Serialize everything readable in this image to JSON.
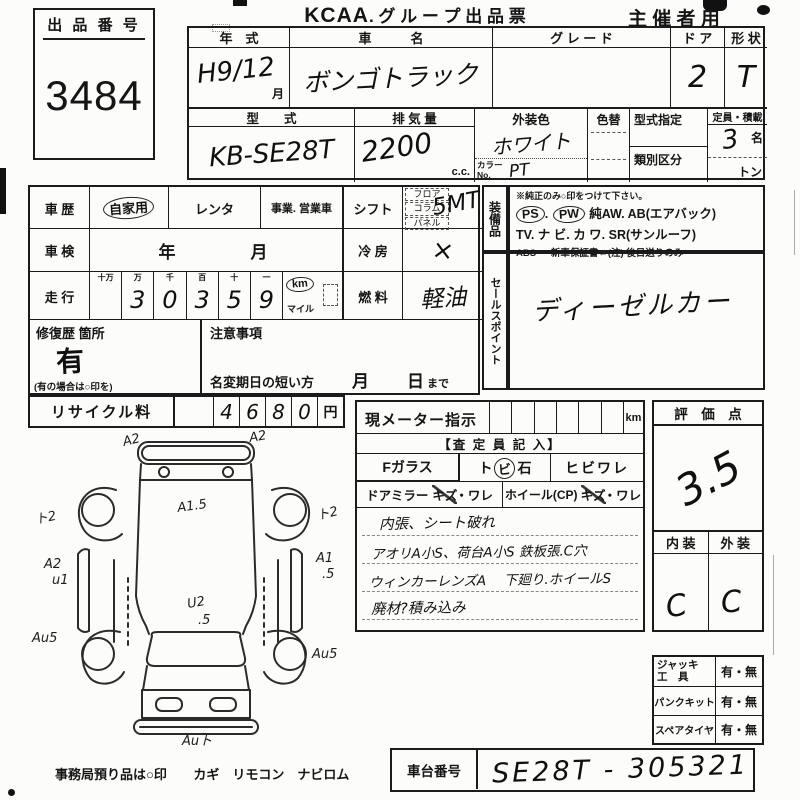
{
  "page": {
    "title_logo": "KCAA",
    "title_text": ". グ ル ー プ  出 品 票",
    "organizer": "主 催 者 用"
  },
  "lot": {
    "label": "出 品 番 号",
    "number": "3484"
  },
  "vehicle": {
    "year_label": "年　式",
    "year_value": "H9/12",
    "year_unit": "月",
    "name_label": "車　　　名",
    "name_value": "ボンゴトラック",
    "grade_label": "グ レ ー ド",
    "grade_value": "",
    "door_label": "ド ア",
    "door_value": "2",
    "shape_label": "形 状",
    "shape_value": "T",
    "model_label": "型　　式",
    "model_value": "KB-SE28T",
    "disp_label": "排 気 量",
    "disp_value": "2200",
    "disp_unit": "c.c.",
    "color_label": "外装色",
    "color_value": "ホワイト",
    "colorchg_label": "色替",
    "colorno_label": "カラーNo.",
    "colorno_value": "PT",
    "modeldesig_label": "型式指定",
    "class_label": "類別区分",
    "capacity_label": "定員・積載",
    "capacity_value": "3",
    "capacity_unit": "名",
    "load_unit": "トン"
  },
  "history": {
    "label": "車 歴",
    "opt1": "自家用",
    "opt2": "レンタ",
    "opt3": "事業. 営業車"
  },
  "shaken": {
    "label": "車 検",
    "value": "年　　　月"
  },
  "mileage": {
    "label": "走 行",
    "h0": "十万",
    "h1": "万",
    "h2": "千",
    "h3": "百",
    "h4": "十",
    "h5": "一",
    "d0": "",
    "d1": "3",
    "d2": "0",
    "d3": "3",
    "d4": "5",
    "d5": "9",
    "unit": "km",
    "unit2": "マイル"
  },
  "shift": {
    "label": "シフト",
    "opt1": "フロア",
    "opt2": "コラム",
    "opt3": "パネル",
    "value": "5MT"
  },
  "aircon": {
    "label": "冷 房",
    "value": "×"
  },
  "fuel": {
    "label": "燃 料",
    "value": "軽油"
  },
  "repair": {
    "label": "修復歴 箇所",
    "value": "有",
    "note": "(有の場合は○印を)"
  },
  "caution": {
    "label": "注意事項",
    "text": "名変期日の短い方",
    "month": "月",
    "day": "日",
    "made": "まで"
  },
  "recycle": {
    "label": "リサイクル料",
    "d0": "4",
    "d1": "6",
    "d2": "8",
    "d3": "0",
    "unit": "円"
  },
  "equipment": {
    "vlabel": "装備品",
    "note": "※純正のみ○印をつけて下さい。",
    "ps": "PS",
    "pw": "PW",
    "line1_rest": "純AW.  AB(エアバック)",
    "line2": "TV.  ナ ビ.  カ ワ.  SR(サンルーフ)",
    "line3": "ABS ・ 新車保証書←(注) 後日送りのみ"
  },
  "sales": {
    "vlabel": "セールスポイント",
    "value": "ディーゼルカー"
  },
  "meter": {
    "label": "現メーター指示",
    "unit": "km"
  },
  "assessor": {
    "header": "【査 定 員 記 入】",
    "fglass": "Fガラス",
    "tobi_pre": "ト",
    "tobi_circle": "ビ",
    "tobi_post": "石",
    "hibiware": "ヒビワレ",
    "mirror_label": "ドアミラー",
    "mirror_kizu": "キズ",
    "mirror_ware": "・ワレ",
    "wheel_label": "ホイール(CP)",
    "wheel_kizu": "キズ",
    "wheel_ware": "・ワレ",
    "note1": "内張、シート破れ",
    "note2": "アオリA小S、荷台A小S 鉄板張.C穴",
    "note3": "ウィンカーレンズA　 下廻り.ホイールS",
    "note4": "廃材?積み込み"
  },
  "rating": {
    "label": "評　価　点",
    "score": "3.5",
    "interior_label": "内 装",
    "exterior_label": "外 装",
    "interior": "C",
    "exterior": "C"
  },
  "tools": {
    "r0l1": "ジャッキ",
    "r0l2": "工　具",
    "r0v": "有・無",
    "r1l": "パンクキット",
    "r1v": "有・無",
    "r2l": "スペアタイヤ",
    "r2v": "有・無"
  },
  "footer": {
    "office": "事務局預り品は○印",
    "items": "カギ　リモコン　ナビロム",
    "chassis_label": "車台番号",
    "chassis_value": "SE28T - 305321"
  },
  "diagram": {
    "annotations": [
      "A2",
      "A2",
      "A1.5",
      "ト2",
      "ト2",
      "A2",
      "u1",
      "A1",
      ".5",
      "U2",
      ".5",
      "Au5",
      "Au5",
      "Auト"
    ]
  }
}
